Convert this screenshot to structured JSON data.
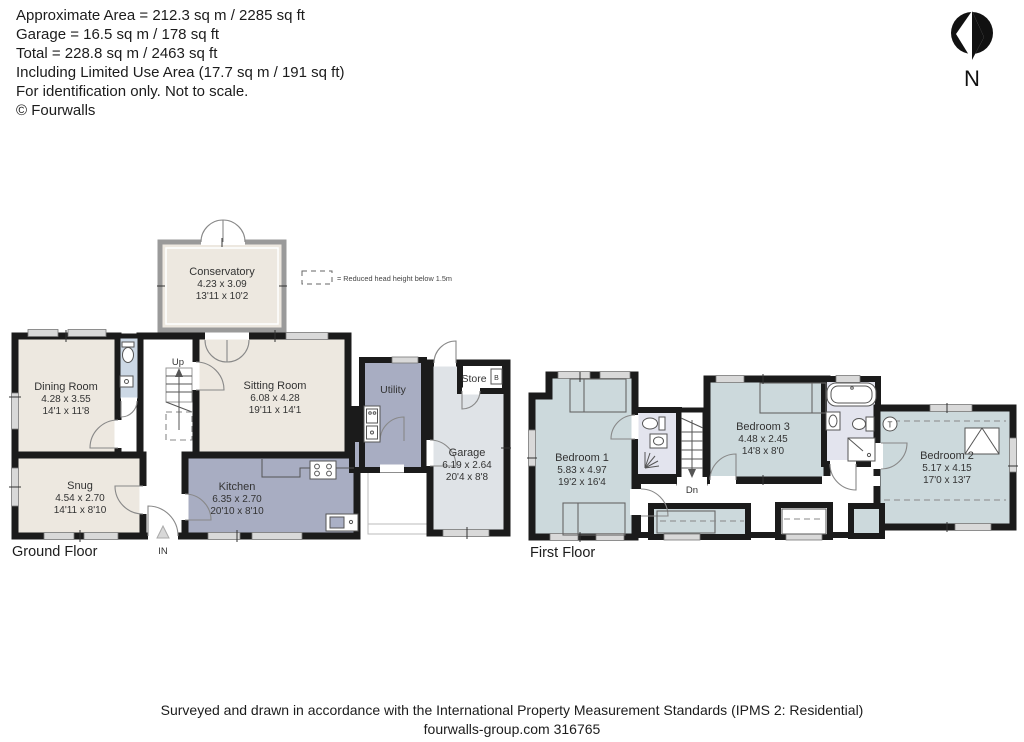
{
  "header": {
    "lines": [
      "Approximate Area = 212.3 sq m / 2285 sq ft",
      "Garage = 16.5 sq m / 178 sq ft",
      "Total = 228.8 sq m / 2463 sq ft",
      "Including Limited Use Area (17.7 sq m / 191 sq ft)",
      "For identification only. Not to scale.",
      "© Fourwalls"
    ]
  },
  "compass": {
    "label": "N"
  },
  "legend": {
    "label": "= Reduced head height below 1.5m"
  },
  "ground_floor": {
    "label": "Ground Floor",
    "annotations": {
      "up": "Up",
      "entrance": "IN",
      "boiler": "B"
    },
    "rooms": {
      "conservatory": {
        "name": "Conservatory",
        "metric": "4.23 x 3.09",
        "imperial": "13'11 x 10'2"
      },
      "dining_room": {
        "name": "Dining Room",
        "metric": "4.28 x 3.55",
        "imperial": "14'1 x 11'8"
      },
      "snug": {
        "name": "Snug",
        "metric": "4.54 x 2.70",
        "imperial": "14'11 x 8'10"
      },
      "sitting_room": {
        "name": "Sitting Room",
        "metric": "6.08 x 4.28",
        "imperial": "19'11 x 14'1"
      },
      "kitchen": {
        "name": "Kitchen",
        "metric": "6.35 x 2.70",
        "imperial": "20'10 x 8'10"
      },
      "utility": {
        "name": "Utility"
      },
      "store": {
        "name": "Store"
      },
      "garage": {
        "name": "Garage",
        "metric": "6.19 x 2.64",
        "imperial": "20'4 x 8'8"
      }
    }
  },
  "first_floor": {
    "label": "First Floor",
    "annotations": {
      "down": "Dn",
      "tank": "T"
    },
    "rooms": {
      "bedroom_1": {
        "name": "Bedroom 1",
        "metric": "5.83 x 4.97",
        "imperial": "19'2 x 16'4"
      },
      "bedroom_3": {
        "name": "Bedroom 3",
        "metric": "4.48 x 2.45",
        "imperial": "14'8 x 8'0"
      },
      "bedroom_2": {
        "name": "Bedroom 2",
        "metric": "5.17 x 4.15",
        "imperial": "17'0 x 13'7"
      }
    }
  },
  "footer": {
    "lines": [
      "Surveyed and drawn in accordance with the International Property Measurement Standards (IPMS 2: Residential)",
      "fourwalls-group.com 316765"
    ]
  },
  "colors": {
    "walls": "#1b1b1b",
    "ground_room_fill": "#ede8e0",
    "kitchen_utility_fill": "#a8adc2",
    "garage_fill": "#dfe3e7",
    "first_floor_fill": "#ccd9dc",
    "bathroom_fill": "#e3e4ee"
  }
}
